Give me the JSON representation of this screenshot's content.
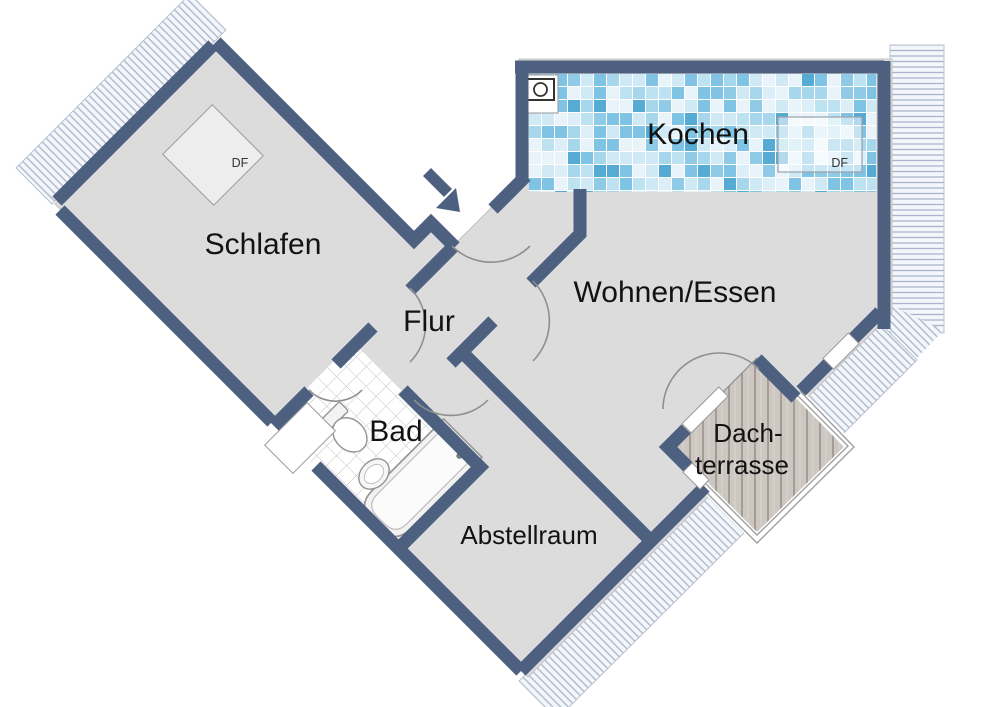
{
  "plan": {
    "type": "apartment-floorplan",
    "rooms": {
      "schlafen": "Schlafen",
      "kochen": "Kochen",
      "wohnen": "Wohnen/Essen",
      "flur": "Flur",
      "bad": "Bad",
      "abstellraum": "Abstellraum",
      "terrasse_line1": "Dach-",
      "terrasse_line2": "terrasse"
    },
    "windows": {
      "roof_window_label": "DF"
    },
    "icons": {
      "stove": "stove-icon",
      "entrance": "entrance-arrow-icon",
      "bathtub": "bathtub-icon",
      "toilet": "toilet-icon",
      "sink": "sink-icon"
    },
    "colors": {
      "wall": "#4d6080",
      "floor": "#dcdcdd",
      "hatch_line": "#a9b5ca",
      "hatch_bg": "#f3f6fa",
      "deck_wood": "#cdc7c2",
      "deck_plank_line": "#a59c95",
      "bad_tile_line": "#c4c4c4",
      "arc": "#8f8f8f",
      "kitchen_tile_palette": [
        "#e8f4fa",
        "#cfe9f5",
        "#cfe9f5",
        "#a6d7ec",
        "#a6d7ec",
        "#7fc4e4",
        "#7fc4e4",
        "#55abd4",
        "#bde2f2",
        "#e8f4fa",
        "#dceff8",
        "#8fcbe7"
      ]
    }
  }
}
